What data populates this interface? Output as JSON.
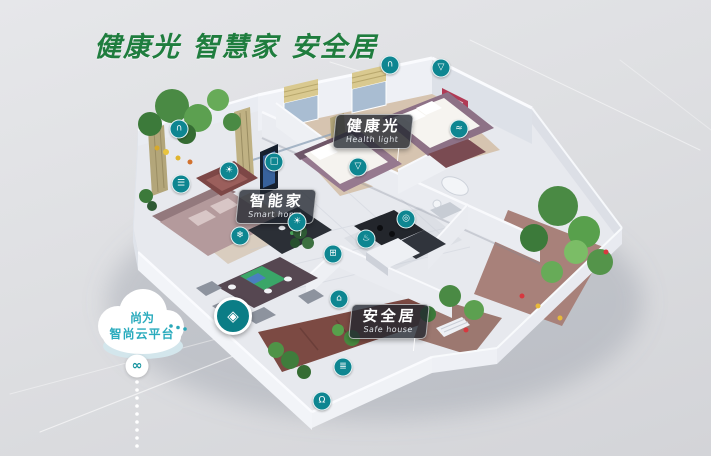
{
  "title": "健康光 智慧家 安全居",
  "labels": [
    {
      "id": "health-light",
      "zh": "健康光",
      "en": "Health light"
    },
    {
      "id": "smart-home",
      "zh": "智能家",
      "en": "Smart home"
    },
    {
      "id": "safe-house",
      "zh": "安全居",
      "en": "Safe house"
    }
  ],
  "cloud": {
    "line1": "尚为",
    "line2": "智尚云平台"
  },
  "colors": {
    "title_green": "#1f7d3e",
    "icon_teal": "#0e8691",
    "cloud_text_teal": "#2aabbd",
    "label_bg": "rgba(33,39,48,0.78)"
  },
  "device_icons": [
    {
      "name": "curtain-icon",
      "glyph": "∩",
      "x": 390,
      "y": 65
    },
    {
      "name": "ceiling-light-icon",
      "glyph": "▽",
      "x": 441,
      "y": 68
    },
    {
      "name": "curtain-icon-2",
      "glyph": "∩",
      "x": 179,
      "y": 129
    },
    {
      "name": "downlight-icon",
      "glyph": "☀",
      "x": 229,
      "y": 171
    },
    {
      "name": "blinds-icon",
      "glyph": "☰",
      "x": 181,
      "y": 184
    },
    {
      "name": "tv-icon",
      "glyph": "□",
      "x": 274,
      "y": 162
    },
    {
      "name": "downlight-icon-2",
      "glyph": "☀",
      "x": 297,
      "y": 222
    },
    {
      "name": "ac-icon",
      "glyph": "❄",
      "x": 240,
      "y": 236
    },
    {
      "name": "bedside-lamp-icon",
      "glyph": "▽",
      "x": 358,
      "y": 167
    },
    {
      "name": "water-heater-icon",
      "glyph": "≈",
      "x": 459,
      "y": 129
    },
    {
      "name": "washer-icon",
      "glyph": "◎",
      "x": 406,
      "y": 219
    },
    {
      "name": "kitchen-hood-icon",
      "glyph": "♨",
      "x": 366,
      "y": 239
    },
    {
      "name": "switch-panel-icon",
      "glyph": "⊞",
      "x": 333,
      "y": 254
    },
    {
      "name": "door-sensor-icon",
      "glyph": "⌂",
      "x": 339,
      "y": 299
    },
    {
      "name": "gate-icon",
      "glyph": "≣",
      "x": 343,
      "y": 367
    },
    {
      "name": "door-lock-icon",
      "glyph": "Ω",
      "x": 322,
      "y": 401
    },
    {
      "name": "cloud-link-icon",
      "glyph": "∞",
      "x": 137,
      "y": 366,
      "kind": "light"
    },
    {
      "name": "smart-hub-badge",
      "glyph": "◈",
      "x": 233,
      "y": 316,
      "kind": "hub"
    }
  ]
}
